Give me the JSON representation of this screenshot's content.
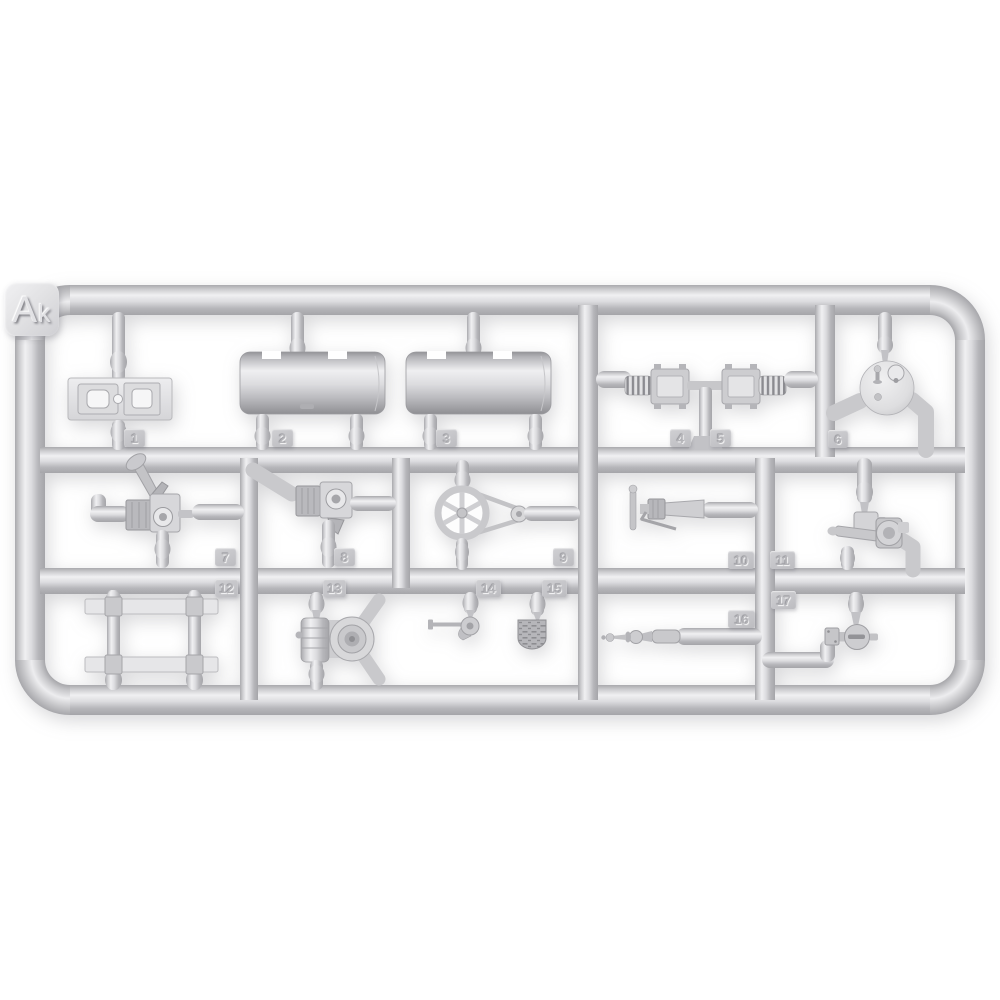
{
  "photo": {
    "description": "Injection-molded light grey plastic model kit sprue photographed on a white background",
    "plastic_color": "#d2d2d5",
    "background_color": "#ffffff"
  },
  "sprue": {
    "label_full": "Ak",
    "label_large": "A",
    "label_small": "k"
  },
  "part_tags": [
    {
      "number": "1",
      "part_name": "mounting-plate"
    },
    {
      "number": "2",
      "part_name": "tank-cylinder-left"
    },
    {
      "number": "3",
      "part_name": "tank-cylinder-right"
    },
    {
      "number": "4",
      "part_name": "spring-coupling-left"
    },
    {
      "number": "5",
      "part_name": "spring-coupling-right"
    },
    {
      "number": "6",
      "part_name": "round-cover-disc"
    },
    {
      "number": "7",
      "part_name": "pedal-valve"
    },
    {
      "number": "8",
      "part_name": "fitting-valve"
    },
    {
      "number": "9",
      "part_name": "pulley-wheel-with-belt"
    },
    {
      "number": "10",
      "part_name": "grease-gun"
    },
    {
      "number": "11",
      "part_name": "lever-valve"
    },
    {
      "number": "12",
      "part_name": "ladder-frame"
    },
    {
      "number": "13",
      "part_name": "pump-with-round-housing"
    },
    {
      "number": "14",
      "part_name": "crank-lever"
    },
    {
      "number": "15",
      "part_name": "tread-plate"
    },
    {
      "number": "16",
      "part_name": "shaft-rod"
    },
    {
      "number": "17",
      "part_name": "ball-valve"
    }
  ]
}
